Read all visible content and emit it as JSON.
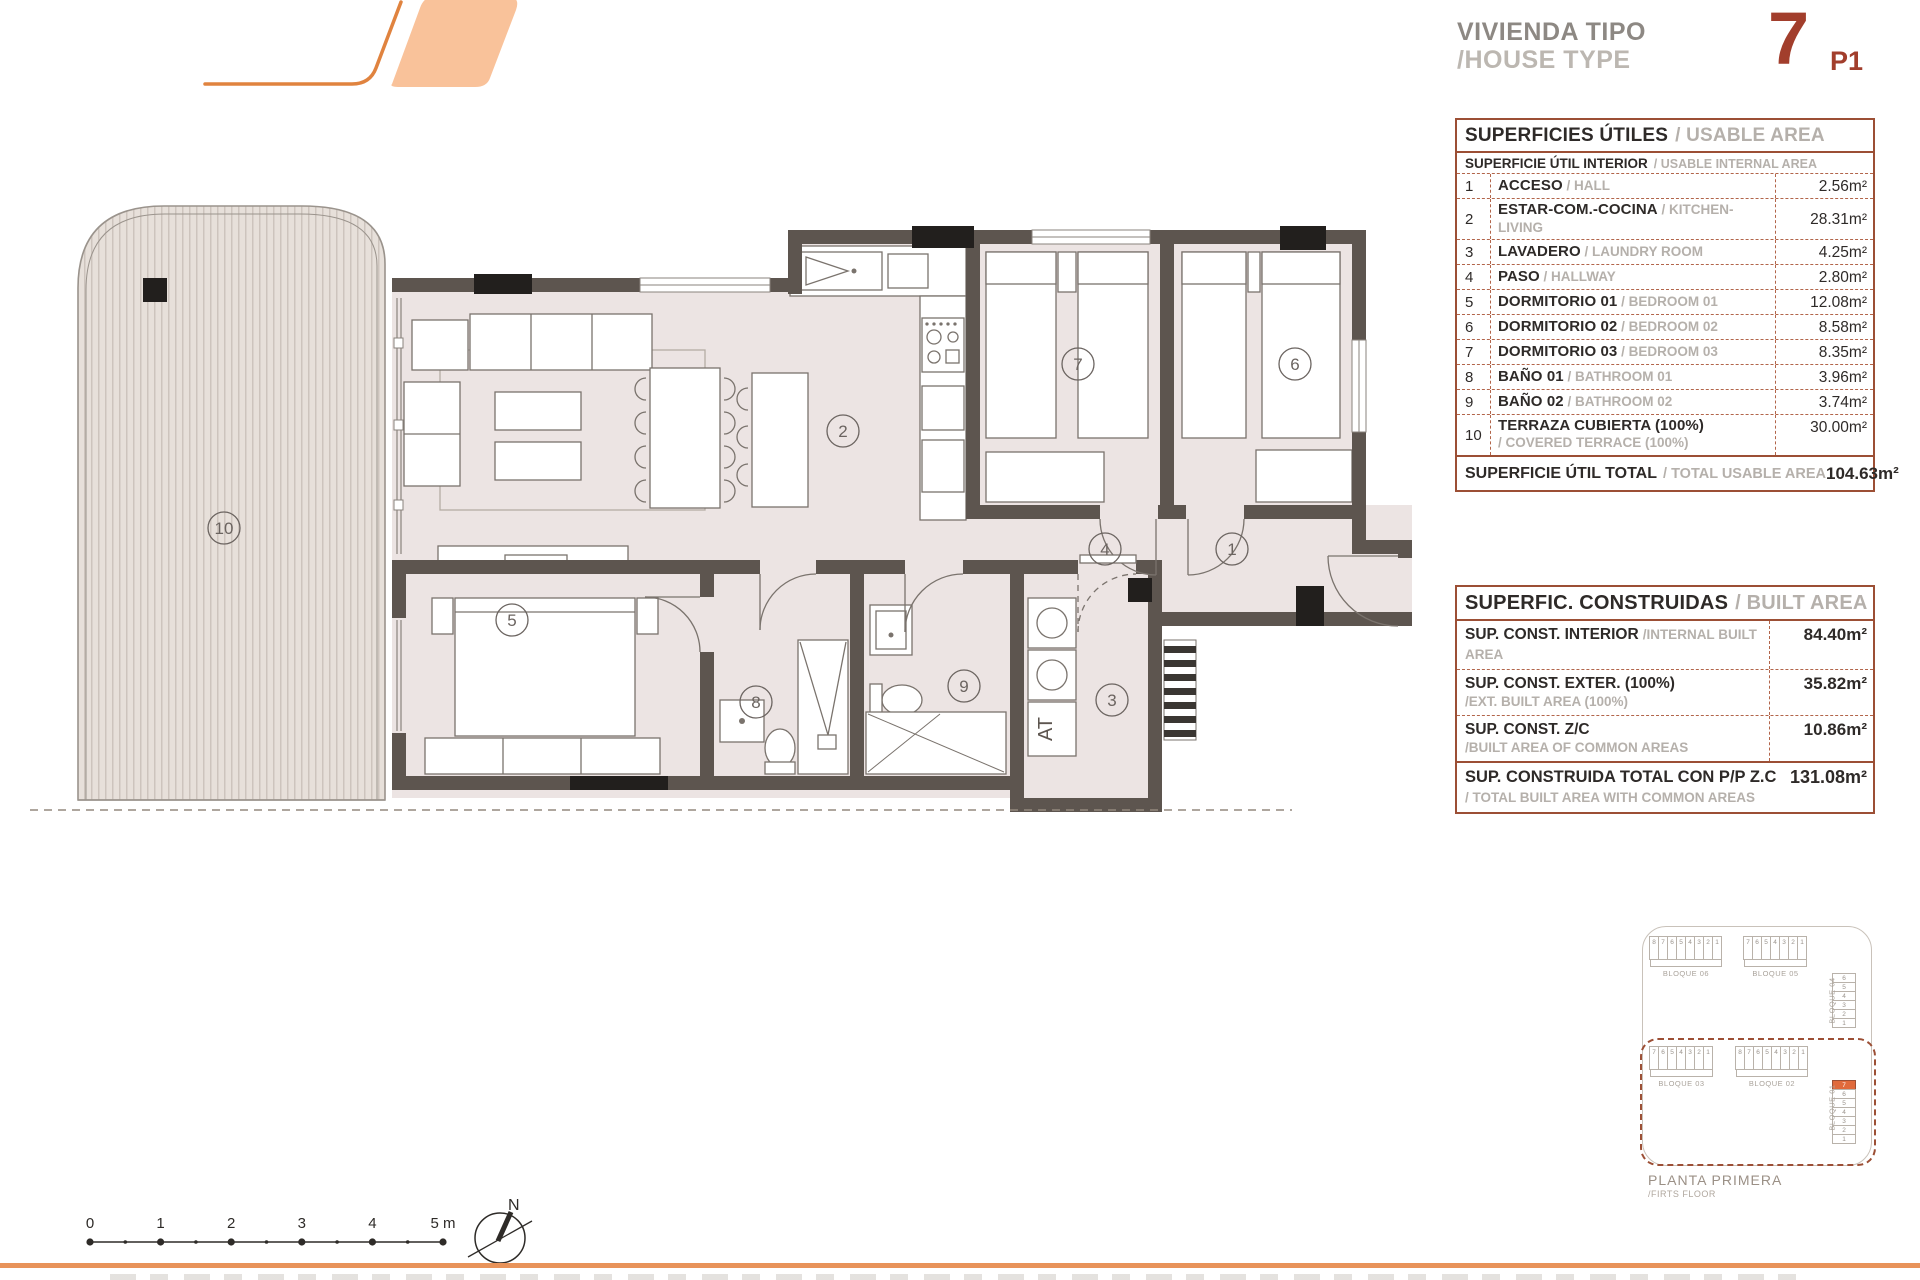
{
  "header": {
    "title_line1": "VIVIENDA TIPO",
    "title_line2": "/HOUSE TYPE",
    "type_number": "7",
    "type_floor": "P1"
  },
  "usable_table": {
    "title_es": "SUPERFICIES ÚTILES",
    "title_en": "/ USABLE AREA",
    "subheader_es": "SUPERFICIE ÚTIL INTERIOR",
    "subheader_en": "/ USABLE INTERNAL AREA",
    "rows": [
      {
        "num": "1",
        "name_es": "ACCESO",
        "name_en": "/ HALL",
        "area": "2.56m²"
      },
      {
        "num": "2",
        "name_es": "ESTAR-COM.-COCINA",
        "name_en": "/ KITCHEN-LIVING",
        "area": "28.31m²"
      },
      {
        "num": "3",
        "name_es": "LAVADERO",
        "name_en": "/ LAUNDRY ROOM",
        "area": "4.25m²"
      },
      {
        "num": "4",
        "name_es": "PASO",
        "name_en": "/ HALLWAY",
        "area": "2.80m²"
      },
      {
        "num": "5",
        "name_es": "DORMITORIO 01",
        "name_en": "/ BEDROOM 01",
        "area": "12.08m²"
      },
      {
        "num": "6",
        "name_es": "DORMITORIO 02",
        "name_en": "/ BEDROOM 02",
        "area": "8.58m²"
      },
      {
        "num": "7",
        "name_es": "DORMITORIO 03",
        "name_en": "/ BEDROOM 03",
        "area": "8.35m²"
      },
      {
        "num": "8",
        "name_es": "BAÑO 01",
        "name_en": "/ BATHROOM 01",
        "area": "3.96m²"
      },
      {
        "num": "9",
        "name_es": "BAÑO 02",
        "name_en": "/ BATHROOM 02",
        "area": "3.74m²"
      },
      {
        "num": "10",
        "name_es": "TERRAZA CUBIERTA (100%)",
        "name_en": "",
        "name_en2": "/ COVERED TERRACE (100%)",
        "area": "30.00m²"
      }
    ],
    "total_label_es": "SUPERFICIE ÚTIL TOTAL",
    "total_label_en": "/ TOTAL USABLE AREA",
    "total_value": "104.63m²"
  },
  "built_table": {
    "title_es": "SUPERFIC. CONSTRUIDAS",
    "title_en": "/ BUILT AREA",
    "rows": [
      {
        "label_es": "SUP. CONST. INTERIOR",
        "label_en": "/INTERNAL BUILT AREA",
        "value": "84.40m²",
        "en_block": false
      },
      {
        "label_es": "SUP. CONST. EXTER. (100%)",
        "label_en": "/EXT. BUILT AREA (100%)",
        "value": "35.82m²",
        "en_block": true
      },
      {
        "label_es": "SUP. CONST. Z/C",
        "label_en": "/BUILT AREA OF COMMON AREAS",
        "value": "10.86m²",
        "en_block": true
      }
    ],
    "total_label_es": "SUP. CONSTRUIDA TOTAL CON P/P Z.C",
    "total_label_en": "/ TOTAL BUILT AREA WITH COMMON AREAS",
    "total_value": "131.08m²"
  },
  "plan": {
    "rooms": [
      "1",
      "2",
      "3",
      "4",
      "5",
      "6",
      "7",
      "8",
      "9",
      "10"
    ],
    "at_label": "AT"
  },
  "site_plan": {
    "bloque06": {
      "label": "BLOQUE 06",
      "cells": [
        "8",
        "7",
        "6",
        "5",
        "4",
        "3",
        "2",
        "1"
      ]
    },
    "bloque05": {
      "label": "BLOQUE 05",
      "cells": [
        "7",
        "6",
        "5",
        "4",
        "3",
        "2",
        "1"
      ]
    },
    "bloque04": {
      "label": "BLOQUE 04",
      "cells": [
        "6",
        "5",
        "4",
        "3",
        "2",
        "1"
      ]
    },
    "bloque03": {
      "label": "BLOQUE 03",
      "cells": [
        "7",
        "6",
        "5",
        "4",
        "3",
        "2",
        "1"
      ]
    },
    "bloque02": {
      "label": "BLOQUE 02",
      "cells": [
        "8",
        "7",
        "6",
        "5",
        "4",
        "3",
        "2",
        "1"
      ]
    },
    "bloque01": {
      "label": "BLOQUE 01",
      "cells": [
        "7",
        "6",
        "5",
        "4",
        "3",
        "2",
        "1"
      ],
      "highlight_index": 0
    },
    "caption_line1": "PLANTA PRIMERA",
    "caption_line2": "/FIRTS FLOOR"
  },
  "scale_bar": {
    "ticks": [
      "0",
      "1",
      "2",
      "3",
      "4",
      "5 m"
    ]
  },
  "north_label": "N",
  "colors": {
    "accent_orange": "#E8935A",
    "logo_fill": "#F9C29A",
    "logo_stroke": "#E0833F",
    "table_border": "#9C4F35",
    "wall": "#5D554F",
    "floor": "#ECE4E3",
    "title_red": "#A23E2C",
    "unit_highlight": "#E06A3C"
  }
}
